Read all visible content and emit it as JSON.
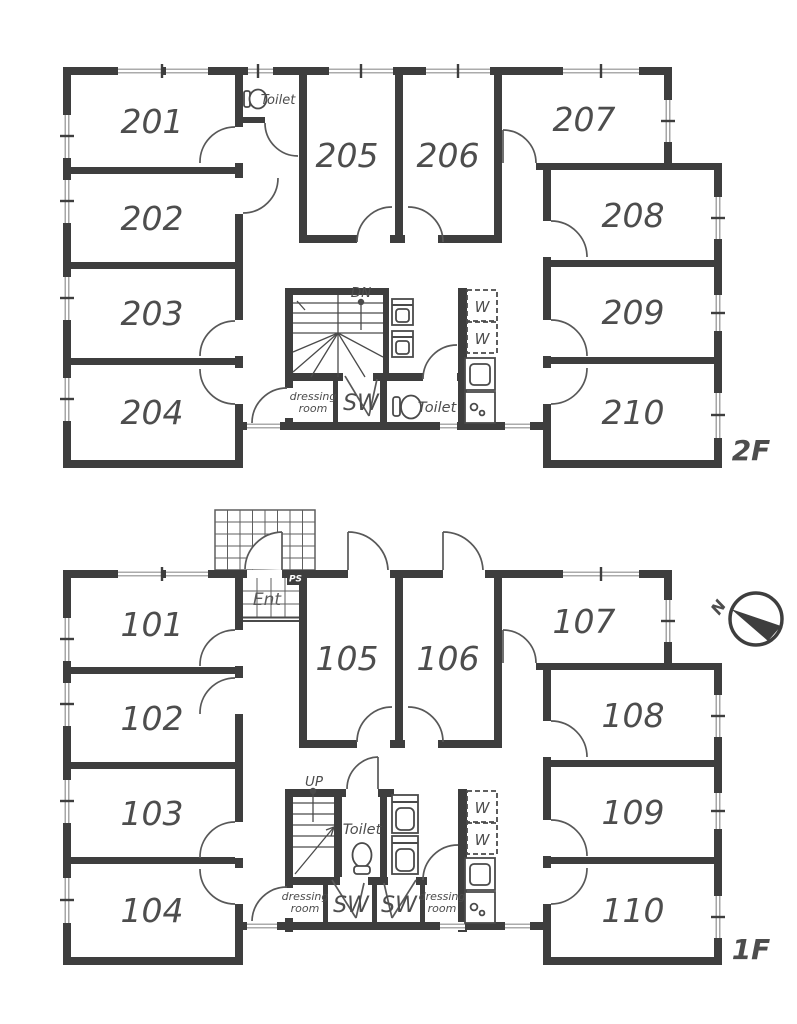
{
  "floor2": {
    "floor_label": "2F",
    "rooms": [
      "201",
      "202",
      "203",
      "204",
      "205",
      "206",
      "207",
      "208",
      "209",
      "210"
    ],
    "toilet_upper_label": "Toilet",
    "toilet_lower_label": "Toilet",
    "stairs_label": "DN",
    "dressing_room_label": [
      "dressing",
      "room"
    ],
    "shower_label": "SW",
    "washer_labels": [
      "W",
      "W"
    ]
  },
  "floor1": {
    "floor_label": "1F",
    "rooms": [
      "101",
      "102",
      "103",
      "104",
      "105",
      "106",
      "107",
      "108",
      "109",
      "110"
    ],
    "entrance_label": "Ent",
    "pipe_shaft_label": "PS",
    "stairs_label": "UP",
    "toilet_label": "Toilet",
    "shower_labels": [
      "SW",
      "SW"
    ],
    "dressing_room_label_left": [
      "dressing",
      "room"
    ],
    "dressing_room_label_right": [
      "dressing",
      "room"
    ],
    "washer_labels": [
      "W",
      "W"
    ],
    "compass_label": "N"
  },
  "colors": {
    "wall": "#3e3e3e",
    "label_text": "#4d4d4d",
    "window_line": "#8f8f8f",
    "background": "#ffffff"
  }
}
